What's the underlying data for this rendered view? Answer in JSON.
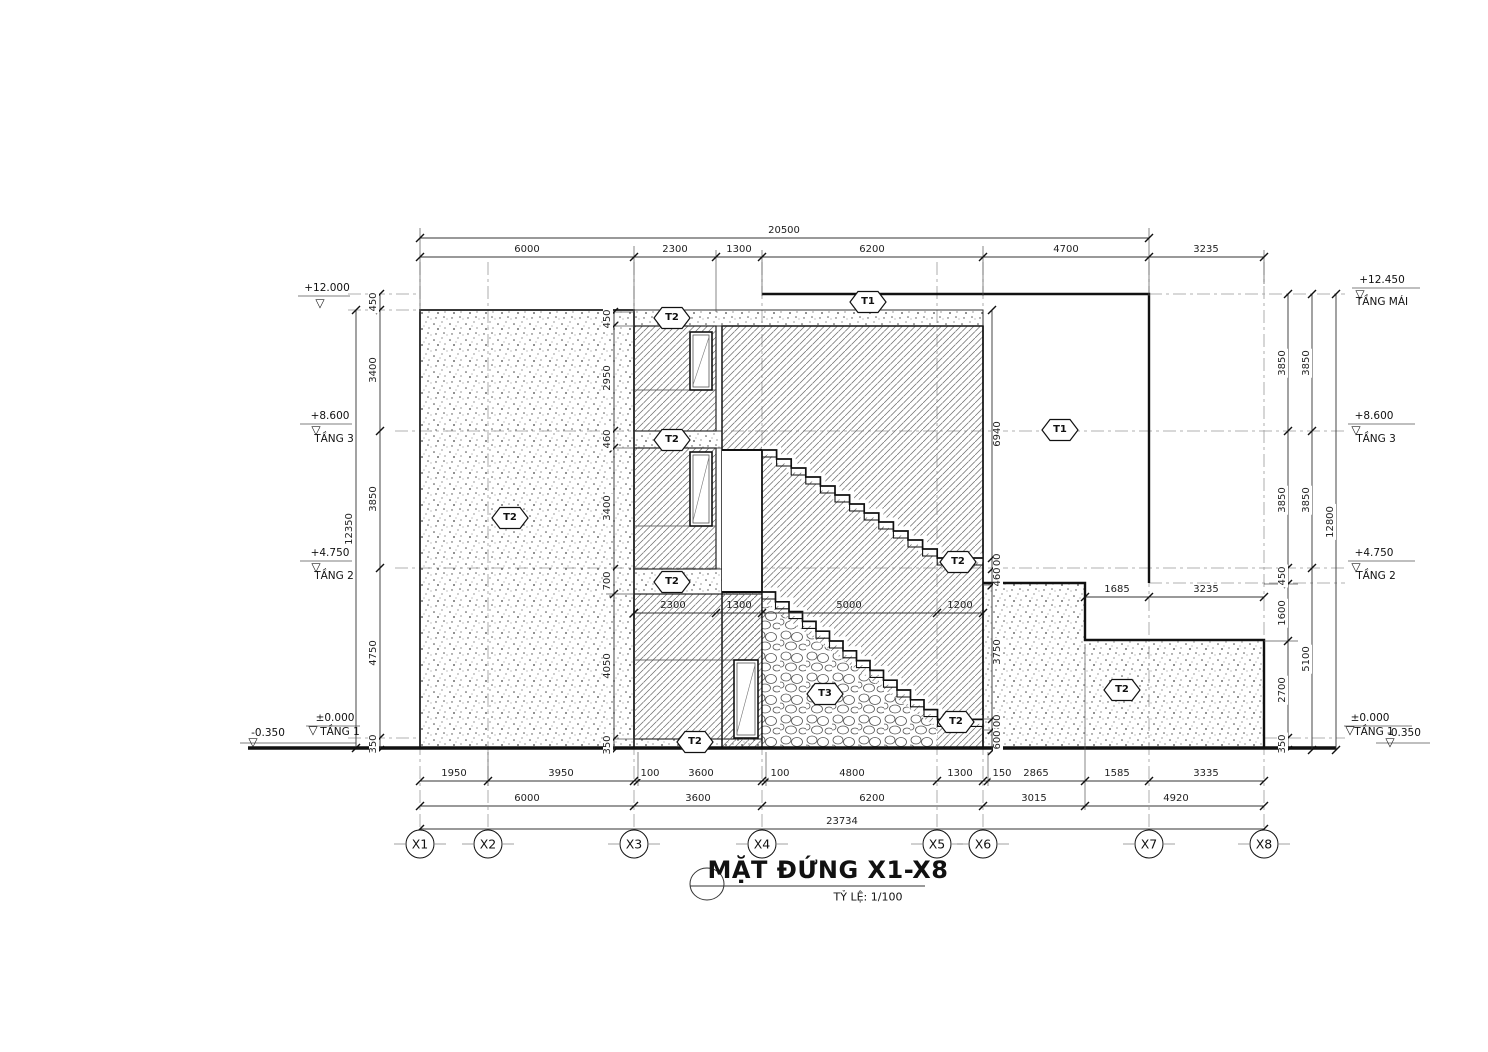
{
  "title": {
    "name": "MẶT ĐỨNG X1-X8",
    "scale": "TỶ LỆ: 1/100"
  },
  "grid": {
    "labels": [
      "X1",
      "X2",
      "X3",
      "X4",
      "X5",
      "X6",
      "X7",
      "X8"
    ]
  },
  "tags": {
    "t1": "T1",
    "t2": "T2",
    "t3": "T3"
  },
  "levels": {
    "left": {
      "roof": {
        "value": "+12.000",
        "name": ""
      },
      "f3": {
        "value": "+8.600",
        "name": "TẦNG 3"
      },
      "f2": {
        "value": "+4.750",
        "name": "TẦNG 2"
      },
      "f1": {
        "value": "±0.000",
        "name": "TẦNG 1"
      },
      "ground": {
        "value": "-0.350"
      }
    },
    "right": {
      "roof": {
        "value": "+12.450",
        "name": "TẦNG MÁI"
      },
      "f3": {
        "value": "+8.600",
        "name": "TẦNG 3"
      },
      "f2": {
        "value": "+4.750",
        "name": "TẦNG 2"
      },
      "f1": {
        "value": "±0.000",
        "name": "TẦNG 1"
      },
      "ground": {
        "value": "-0.350"
      }
    }
  },
  "dims": {
    "top_overall": "20500",
    "top_row": [
      "6000",
      "2300",
      "1300",
      "6200",
      "4700"
    ],
    "top_right": "3235",
    "bottom_row1": [
      "1950",
      "3950",
      "100",
      "3600",
      "100",
      "4800",
      "1300",
      "150",
      "2865",
      "1585",
      "3335"
    ],
    "bottom_row2": [
      "6000",
      "3600",
      "6200",
      "3015",
      "4920"
    ],
    "bottom_overall": "23734",
    "left_chain": [
      "450",
      "3400",
      "3850",
      "4750",
      "350"
    ],
    "left_overall": "12350",
    "right_chain_a": [
      "3850",
      "3850",
      "450",
      "1600",
      "2700",
      "350"
    ],
    "right_chain_b": [
      "3850",
      "3850",
      "5100"
    ],
    "right_overall": "12800",
    "mid_left_chain": [
      "450",
      "2950",
      "460",
      "3400",
      "700",
      "4050",
      "350"
    ],
    "mid_right_chain": [
      "6940",
      "300",
      "460",
      "3750",
      "300",
      "600"
    ],
    "stair_row": [
      "2300",
      "1300",
      "5000",
      "1200"
    ],
    "notch_row": [
      "1685",
      "3235"
    ]
  }
}
